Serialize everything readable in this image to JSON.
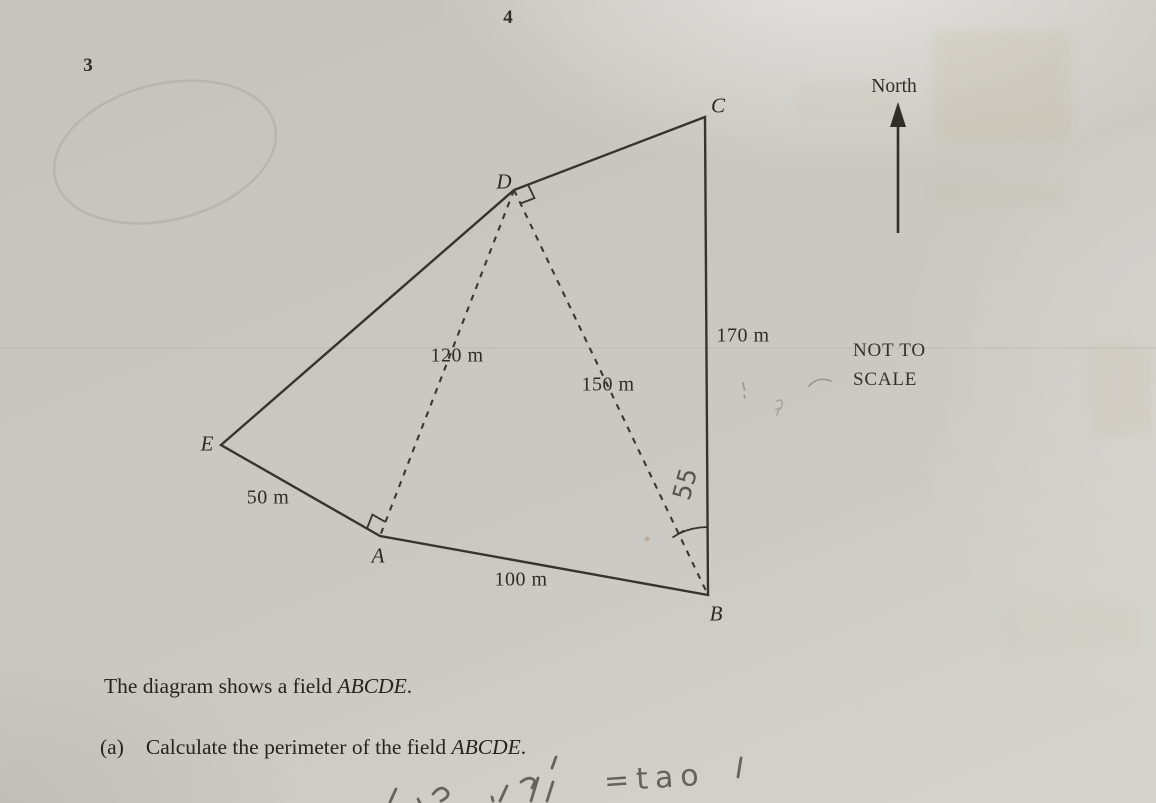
{
  "page": {
    "number": "4",
    "question_number": "3"
  },
  "diagram": {
    "north_label": "North",
    "scale_note_line1": "NOT TO",
    "scale_note_line2": "SCALE",
    "vertices": {
      "A": "A",
      "B": "B",
      "C": "C",
      "D": "D",
      "E": "E"
    },
    "measurements": {
      "DA": "120 m",
      "DB": "150 m",
      "CB": "170 m",
      "EA": "50 m",
      "AB": "100 m"
    },
    "handwritten_angle_note": "55"
  },
  "body_text": {
    "caption_prefix": "The diagram shows a field ",
    "caption_name": "ABCDE",
    "caption_suffix": ".",
    "part_a_label": "(a)",
    "part_a_prefix": "Calculate the perimeter of the field ",
    "part_a_name": "ABCDE",
    "part_a_suffix": "."
  },
  "handwriting": {
    "bottom_note": "=tao"
  },
  "colors": {
    "paper": "#cac8c2",
    "ink": "#35342e",
    "pencil": "#4e4b45"
  }
}
